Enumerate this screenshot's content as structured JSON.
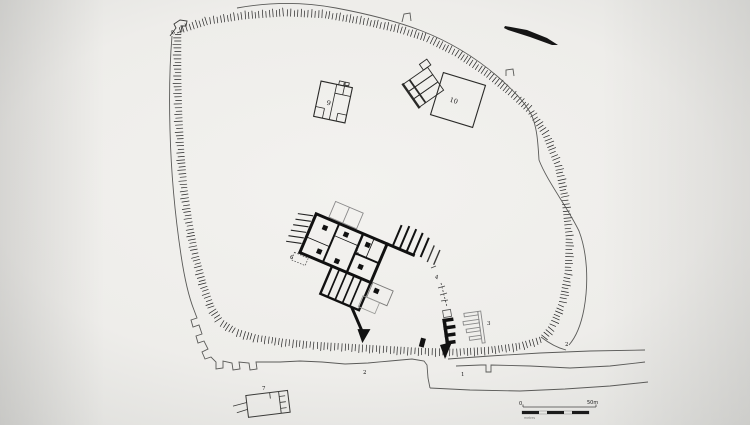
{
  "plan": {
    "structure_labels": {
      "n1": "1",
      "n2": "2",
      "n3": "3",
      "n4": "4",
      "n5": "5",
      "n6": "6",
      "n7": "7",
      "n8": "8",
      "n9": "9",
      "n10": "10"
    },
    "scale_bar": {
      "zero_label": "0",
      "end_label": "50m",
      "unit_caption": "metres"
    },
    "colors": {
      "ink": "#1b1b1b",
      "faint_line": "#8a8a8a",
      "background_center": "#f2f1ee",
      "background_edge": "#c3c2c0"
    }
  }
}
